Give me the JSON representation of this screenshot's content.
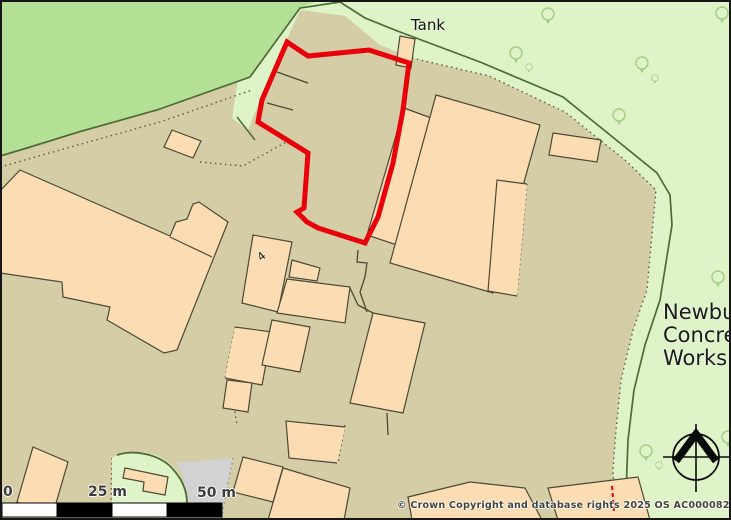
{
  "map": {
    "labels": {
      "tank": "Tank",
      "plot_number": "4"
    },
    "area_label": {
      "lines": [
        "Newbury",
        "Concrete",
        "Works"
      ]
    },
    "scale_bar": {
      "start_label": "0",
      "mid_label": "25 m",
      "end_label": "50 m"
    },
    "attribution": "© Crown Copyright and database rights 2025 OS AC0000829429",
    "icons": {
      "compass": "north-compass-icon",
      "tree": "deciduous-tree-icon"
    },
    "colors": {
      "woodland_green": "#b4e095",
      "verge_light_green": "#def3c8",
      "ground_tan": "#d4cda5",
      "building_fill": "#fcdcb3",
      "building_outline": "#4b4936",
      "site_boundary_red": "#e8000a",
      "hardstanding_gray": "#d2d2d2",
      "hedge_line_green": "#4c6b36",
      "scale_bar_black": "#000000",
      "scale_bar_white": "#ffffff"
    }
  }
}
